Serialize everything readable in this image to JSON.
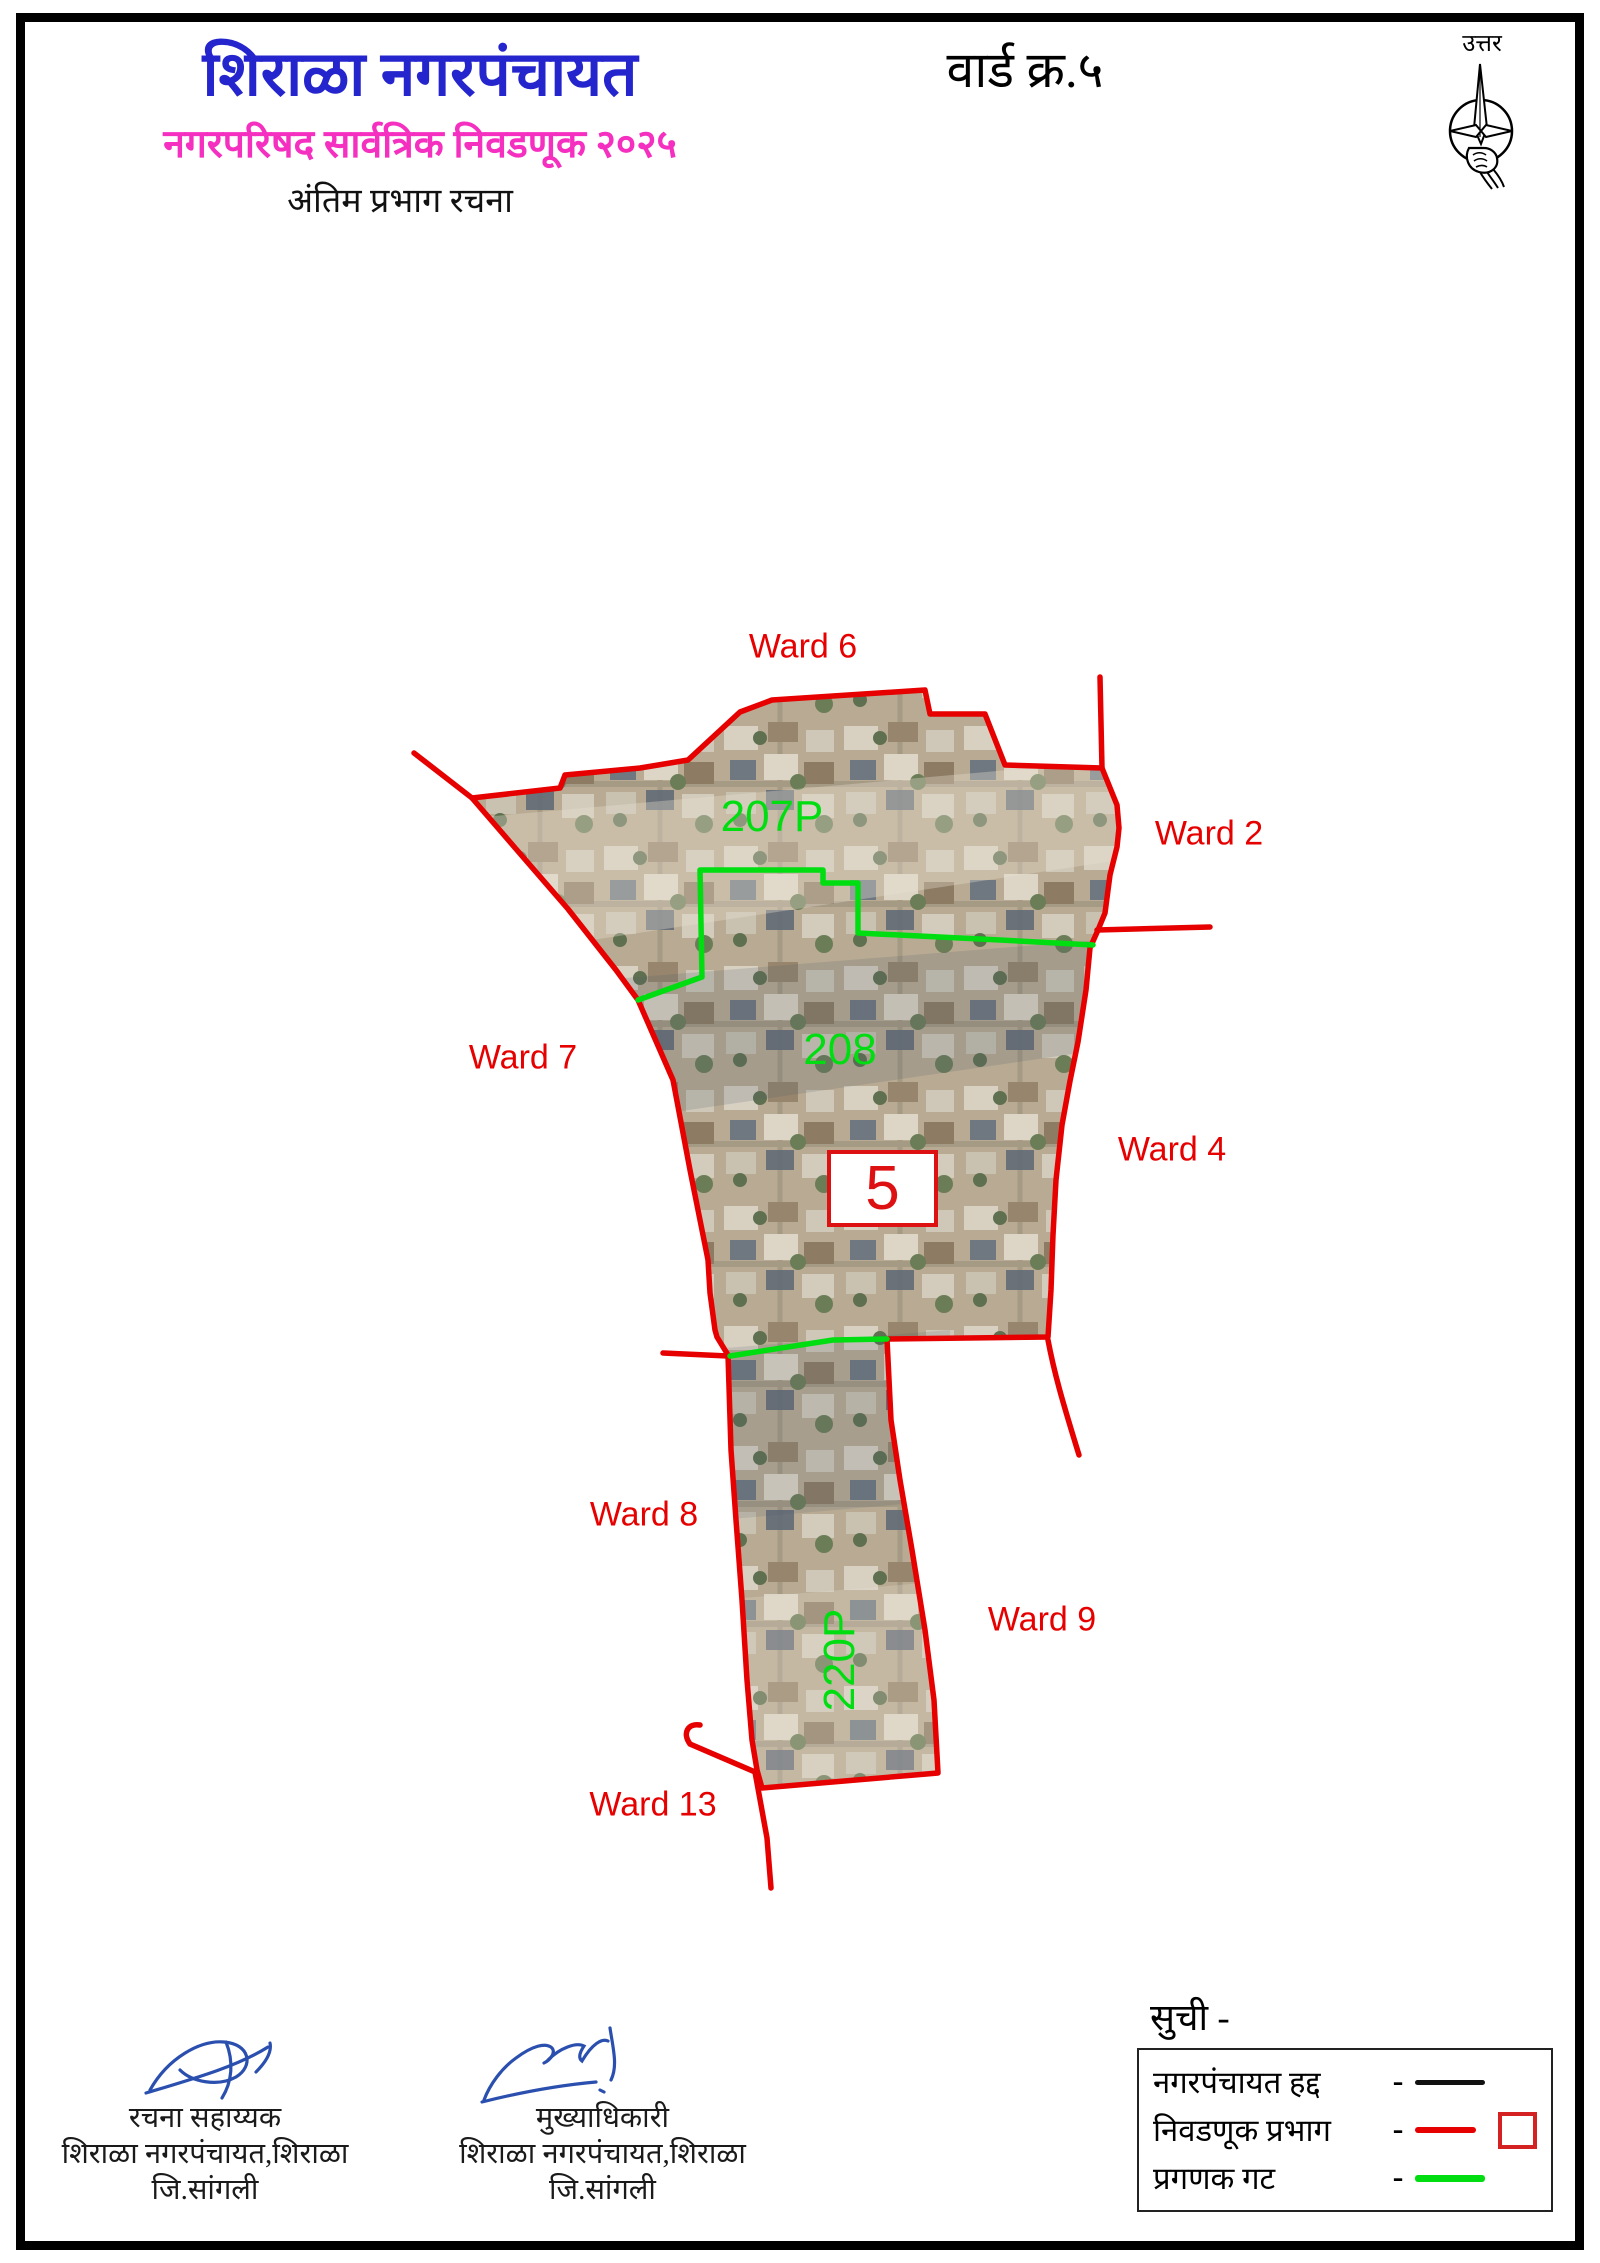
{
  "header": {
    "title": "शिराळा नगरपंचायत",
    "subtitle": "नगरपरिषद सार्वत्रिक निवडणूक २०२५",
    "subtitle2": "अंतिम प्रभाग रचना",
    "ward_heading": "वार्ड क्र.५",
    "compass_label": "उत्तर"
  },
  "map": {
    "ward_box_number": "5",
    "ward_labels": [
      {
        "text": "Ward 6"
      },
      {
        "text": "Ward 2"
      },
      {
        "text": "Ward 7"
      },
      {
        "text": "Ward 4"
      },
      {
        "text": "Ward 8"
      },
      {
        "text": "Ward 9"
      },
      {
        "text": "Ward 13"
      }
    ],
    "group_labels": [
      {
        "text": "207P"
      },
      {
        "text": "208"
      },
      {
        "text": "220P"
      }
    ]
  },
  "signatures": {
    "left": {
      "role": "रचना सहाय्यक",
      "org": "शिराळा नगरपंचायत,शिराळा",
      "district": "जि.सांगली"
    },
    "right": {
      "role": "मुख्याधिकारी",
      "org": "शिराळा नगरपंचायत,शिराळा",
      "district": "जि.सांगली"
    }
  },
  "legend": {
    "title": "सुची -",
    "items": [
      {
        "label": "नगरपंचायत हद्द",
        "dash": "-",
        "color": "#111111",
        "style": "black-line"
      },
      {
        "label": "निवडणूक प्रभाग",
        "dash": "-",
        "color": "#e60000",
        "style": "red-line-with-square"
      },
      {
        "label": "प्रगणक गट",
        "dash": "-",
        "color": "#00dd11",
        "style": "green-line"
      }
    ]
  },
  "colors": {
    "title_blue": "#2525cd",
    "subtitle_magenta": "#f52fc0",
    "boundary_red": "#e60000",
    "group_green": "#00dd11",
    "municipal_black": "#111111",
    "signature_ink_blue": "#2a4fae"
  }
}
